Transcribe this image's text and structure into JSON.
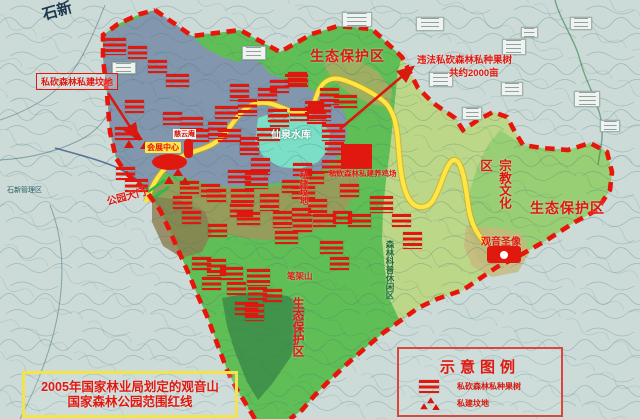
{
  "map": {
    "type": "annotated_planning_map",
    "description_boxes": {
      "redline_note_line1": "2005年国家林业局划定的观音山",
      "redline_note_line2": "国家森林公园范围红线"
    },
    "zones": {
      "eco_top": "生态保护区",
      "eco_right": "生态保护区",
      "eco_bottom": "生态保护区",
      "religion_culture": "宗教文化区",
      "forest_science_leisure": "森林科普休闲区"
    },
    "places": {
      "guanyin_statue": "观音圣像",
      "convention_center": "会展中心",
      "ciyun_temple": "慈云庵",
      "xianquan_reservoir": "仙泉水库",
      "bijia_mountain": "笔架山",
      "park_gate": "公园大门",
      "base_town": "石新",
      "base_admin_area": "石新管理区"
    },
    "annotations": {
      "grave_note": "私砍森林私建坟地",
      "orchard_note_line1": "违法私砍森林私种果树",
      "orchard_note_line2": "共约2000亩",
      "chicken_farm_note": "私砍森林私建养鸡场",
      "grave_vertical": "私建坟地"
    },
    "colors": {
      "red_accent": "#e0180f",
      "boundary_red_line": "#e8150a",
      "road_yellow": "#ffe643",
      "reservoir_teal": "#7adfc6",
      "park_green": "#5fbe56",
      "blue_zone": "#8297ad",
      "olive_zone": "#a09659",
      "east_light_green": "#bcd788",
      "base_topo": "#ccdbd8",
      "note_box_yellow": "#f3e44c"
    }
  },
  "legend": {
    "title": "示意图例",
    "items": [
      {
        "icon": "red-bars-icon",
        "label": "私砍森林私种果树"
      },
      {
        "icon": "red-graves-icon",
        "label": "私建坟地"
      }
    ]
  },
  "markers": {
    "illegal_logging_sites": [
      [
        103,
        38
      ],
      [
        128,
        46
      ],
      [
        148,
        60
      ],
      [
        166,
        74
      ],
      [
        230,
        84
      ],
      [
        258,
        88
      ],
      [
        285,
        74
      ],
      [
        305,
        101
      ],
      [
        238,
        99
      ],
      [
        215,
        106
      ],
      [
        268,
        109
      ],
      [
        290,
        108
      ],
      [
        308,
        104
      ],
      [
        125,
        100
      ],
      [
        163,
        112
      ],
      [
        180,
        117
      ],
      [
        208,
        122
      ],
      [
        190,
        129
      ],
      [
        218,
        129
      ],
      [
        240,
        142
      ],
      [
        251,
        158
      ],
      [
        228,
        170
      ],
      [
        180,
        181
      ],
      [
        201,
        184
      ],
      [
        231,
        189
      ],
      [
        115,
        127
      ],
      [
        116,
        167
      ],
      [
        125,
        179
      ],
      [
        320,
        88
      ],
      [
        325,
        142
      ],
      [
        334,
        95
      ],
      [
        270,
        80
      ],
      [
        240,
        137
      ],
      [
        257,
        128
      ],
      [
        270,
        114
      ],
      [
        307,
        111
      ],
      [
        322,
        124
      ],
      [
        322,
        160
      ],
      [
        305,
        171
      ],
      [
        292,
        186
      ],
      [
        308,
        199
      ],
      [
        292,
        208
      ],
      [
        313,
        214
      ],
      [
        282,
        180
      ],
      [
        260,
        194
      ],
      [
        230,
        204
      ],
      [
        207,
        189
      ],
      [
        173,
        196
      ],
      [
        245,
        172
      ],
      [
        182,
        211
      ],
      [
        208,
        224
      ],
      [
        237,
        212
      ],
      [
        273,
        211
      ],
      [
        293,
        219
      ],
      [
        275,
        231
      ],
      [
        192,
        257
      ],
      [
        207,
        259
      ],
      [
        220,
        267
      ],
      [
        202,
        277
      ],
      [
        227,
        282
      ],
      [
        247,
        269
      ],
      [
        248,
        287
      ],
      [
        263,
        289
      ],
      [
        235,
        302
      ],
      [
        245,
        304
      ],
      [
        333,
        211
      ],
      [
        348,
        214
      ],
      [
        392,
        214
      ],
      [
        403,
        232
      ],
      [
        320,
        241
      ],
      [
        330,
        257
      ],
      [
        340,
        184
      ],
      [
        370,
        196
      ],
      [
        288,
        72
      ],
      [
        293,
        163
      ]
    ],
    "grave_sites": [
      [
        124,
        131
      ],
      [
        164,
        167
      ]
    ],
    "base_label_boxes": [
      [
        342,
        12,
        28,
        13
      ],
      [
        416,
        17,
        26,
        12
      ],
      [
        570,
        17,
        20,
        11
      ],
      [
        502,
        39,
        22,
        14
      ],
      [
        429,
        72,
        22,
        13
      ],
      [
        501,
        82,
        20,
        12
      ],
      [
        574,
        91,
        24,
        14
      ],
      [
        462,
        107,
        18,
        11
      ],
      [
        242,
        46,
        22,
        12
      ],
      [
        112,
        62,
        22,
        10
      ],
      [
        521,
        27,
        15,
        9
      ],
      [
        600,
        120,
        18,
        10
      ]
    ]
  }
}
